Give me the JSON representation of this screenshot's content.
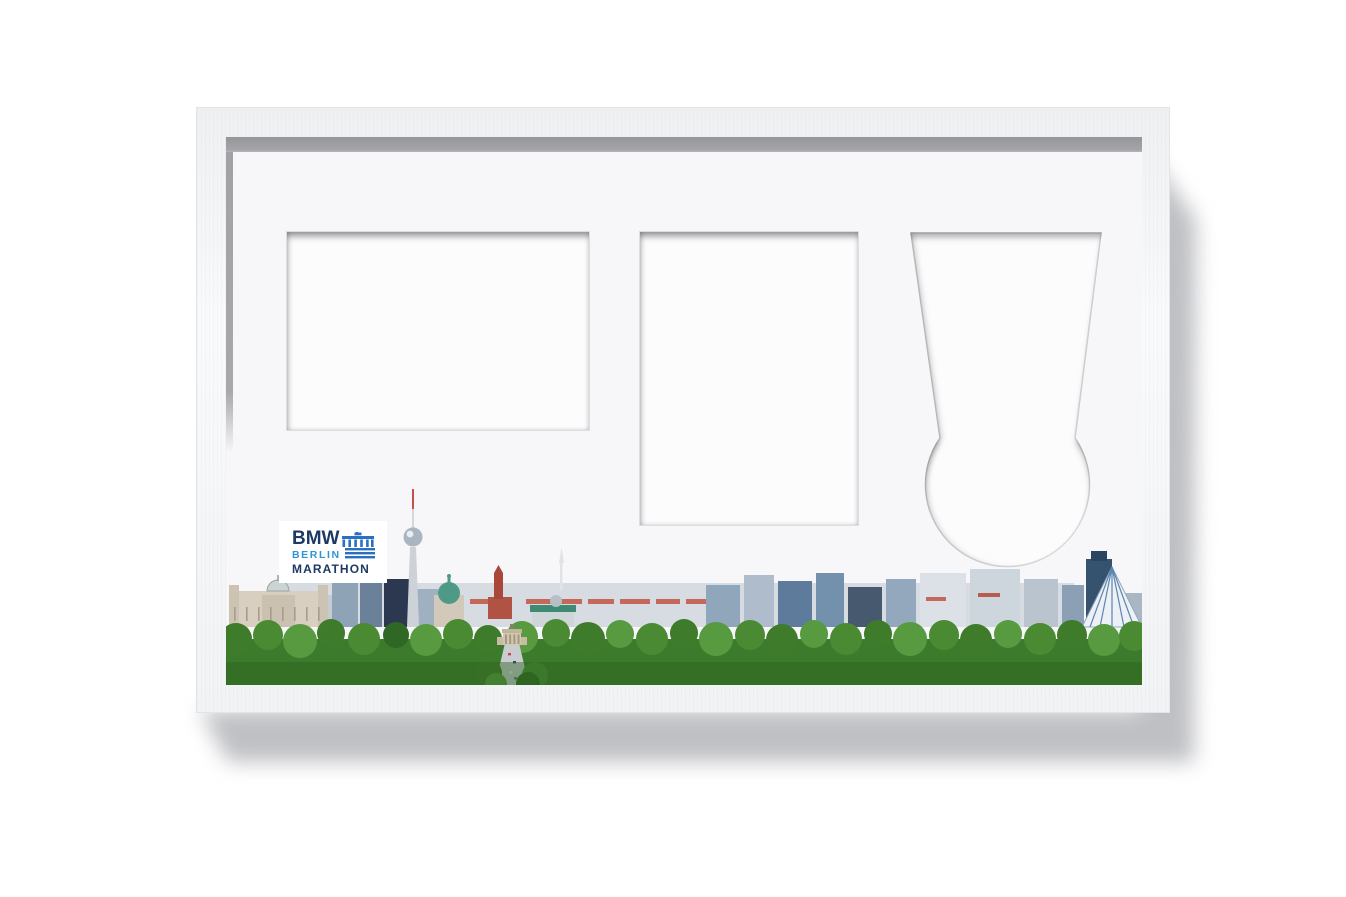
{
  "scene": {
    "type": "product-photo",
    "subject": "White triple-opening picture frame for BMW Berlin Marathon photo, certificate and medal, with Berlin skyline panorama on the mat",
    "background_color": "#ffffff"
  },
  "frame": {
    "molding_color": "#f5f6f8",
    "molding_edge_color": "#e2e4e8",
    "mat_color": "#f7f7f9",
    "inner_lip_shadow_color": "#9b9b9f",
    "drop_shadow_color": "#bfc0c4",
    "opening_fill_color": "#fcfcfd",
    "opening_bevel_color": "#dcdde0"
  },
  "openings": [
    {
      "name": "landscape-photo-opening",
      "shape": "rectangle"
    },
    {
      "name": "portrait-opening",
      "shape": "rectangle"
    },
    {
      "name": "medal-opening",
      "shape": "tapered-ribbon-with-circle"
    }
  ],
  "logo": {
    "line1": "BMW",
    "line2": "BERLIN",
    "line3": "MARATHON",
    "navy": "#1d3a64",
    "light_blue": "#2f93d8",
    "gate_blue": "#2a70c2",
    "card_background": "#ffffff"
  },
  "skyline": {
    "sky_color": "#fcfdfe",
    "tree_colors": [
      "#4a8a33",
      "#3e7b2a",
      "#579a40",
      "#2f6824"
    ],
    "road_color": "#c9cdd1",
    "landmark_icons": [
      "reichstag-icon",
      "tv-tower-icon",
      "berlin-cathedral-icon",
      "rotes-rathaus-icon",
      "brandenburg-gate-icon",
      "road-17-juni-icon",
      "tiergarten-trees-icon",
      "potsdamer-tower-icon",
      "sony-center-tent-icon"
    ]
  }
}
